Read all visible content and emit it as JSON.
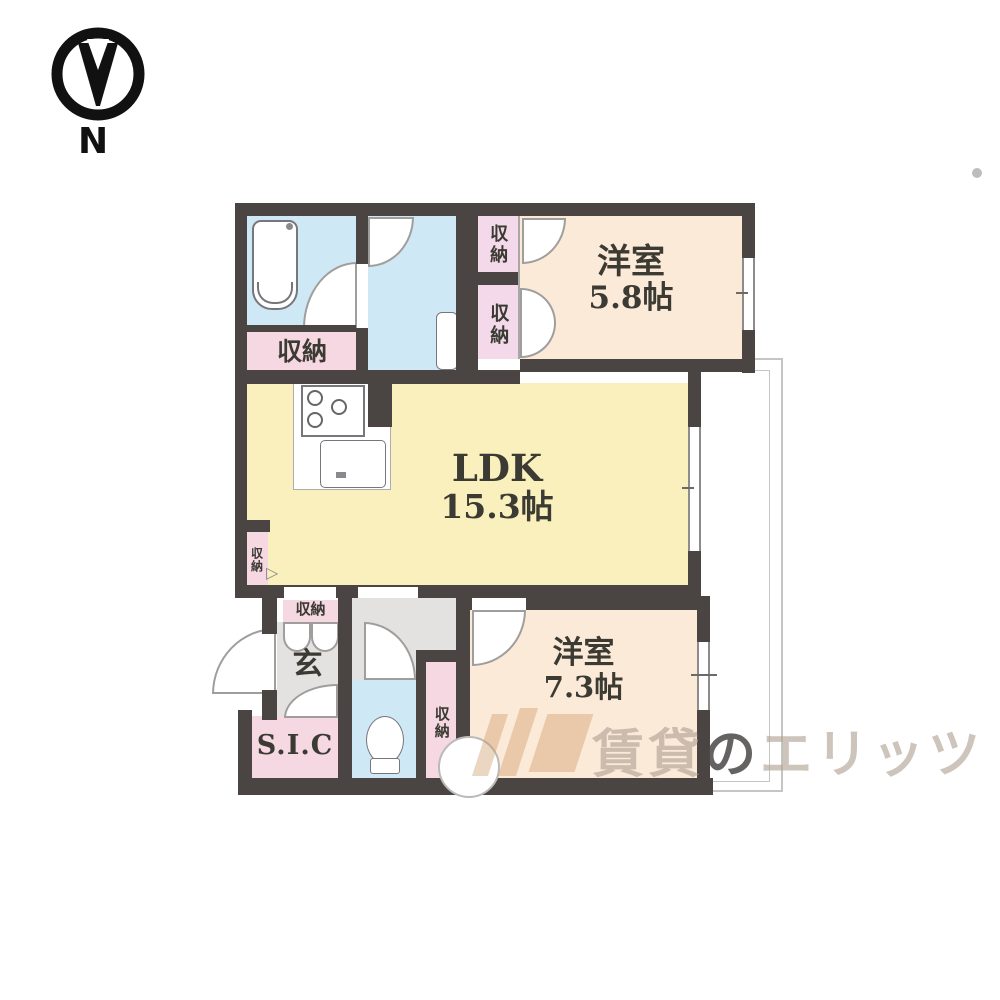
{
  "compass": {
    "north_label": "N"
  },
  "rooms": {
    "bedroom_top": {
      "name": "洋室",
      "area": "5.8帖"
    },
    "ldk": {
      "name": "LDK",
      "area": "15.3帖"
    },
    "bedroom_bottom": {
      "name": "洋室",
      "area": "7.3帖"
    },
    "entrance": {
      "label": "玄"
    },
    "shoe_closet": {
      "label": "S.I.C"
    }
  },
  "labels": {
    "storage": "収納"
  },
  "watermark": {
    "part1": "賃貸",
    "part2": "の",
    "part3": "エリッツ"
  },
  "colors": {
    "wall": "#4a4542",
    "bedroom_floor": "#fcead9",
    "ldk_floor": "#f9f0bd",
    "wet_area_floor": "#cfe8f5",
    "storage_fill": "#f6d8e2",
    "closet_fill": "#f3d9e9",
    "hall_floor": "#e3e2e0",
    "watermark": "#ae9f92"
  }
}
